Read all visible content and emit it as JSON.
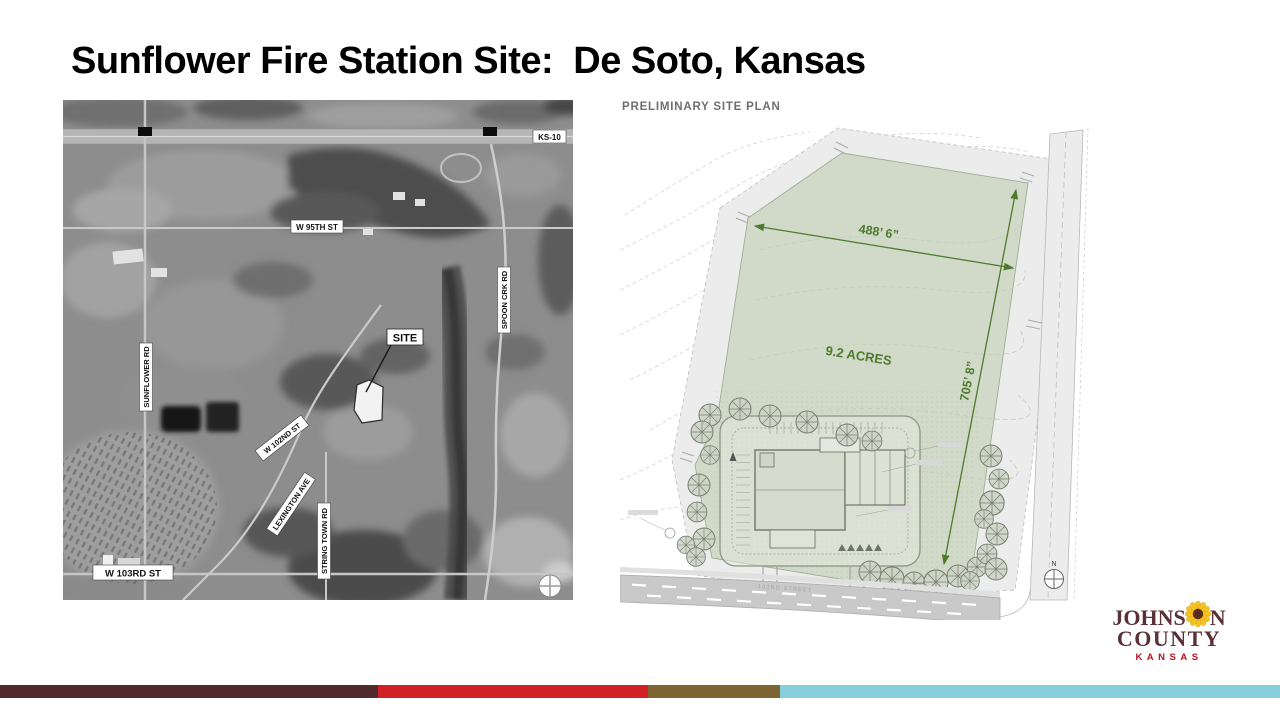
{
  "slide": {
    "title": "Sunflower Fire Station Site:  De Soto, Kansas"
  },
  "aerial_map": {
    "labels": {
      "highway": "KS-10",
      "w_95th": "W 95TH ST",
      "sunflower_rd": "SUNFLOWER RD",
      "spoon_creek_rd": "SPOON CRK RD",
      "w_102nd": "W 102ND ST",
      "lexington_ave": "LEXINGTON AVE",
      "string_town_rd": "STRING TOWN RD",
      "w_103rd": "W 103RD ST",
      "site_marker": "SITE"
    }
  },
  "site_plan": {
    "heading": "PRELIMINARY SITE PLAN",
    "parcel": {
      "width": "488’ 6”",
      "depth": "705’ 8”",
      "area": "9.2 ACRES"
    },
    "street_label": "102ND STREET",
    "north_label": "N",
    "colors": {
      "parcel_fill": "#cfd8c5",
      "dimension_green": "#4d7a2b"
    }
  },
  "logo": {
    "name_prefix": "JOHNS",
    "name_suffix": "N",
    "county": "COUNTY",
    "state": "KANSAS",
    "colors": {
      "wordmark": "#5b3137",
      "state_red": "#b5121e",
      "petal_yellow": "#f5c21f",
      "flower_center": "#4f2c1e"
    }
  },
  "footer_stripes": [
    {
      "name": "dark-maroon",
      "color": "#52292c",
      "width": 378
    },
    {
      "name": "red",
      "color": "#d22027",
      "width": 270
    },
    {
      "name": "olive",
      "color": "#7d6433",
      "width": 132
    },
    {
      "name": "sky-blue",
      "color": "#87cedb",
      "width": 500
    }
  ]
}
